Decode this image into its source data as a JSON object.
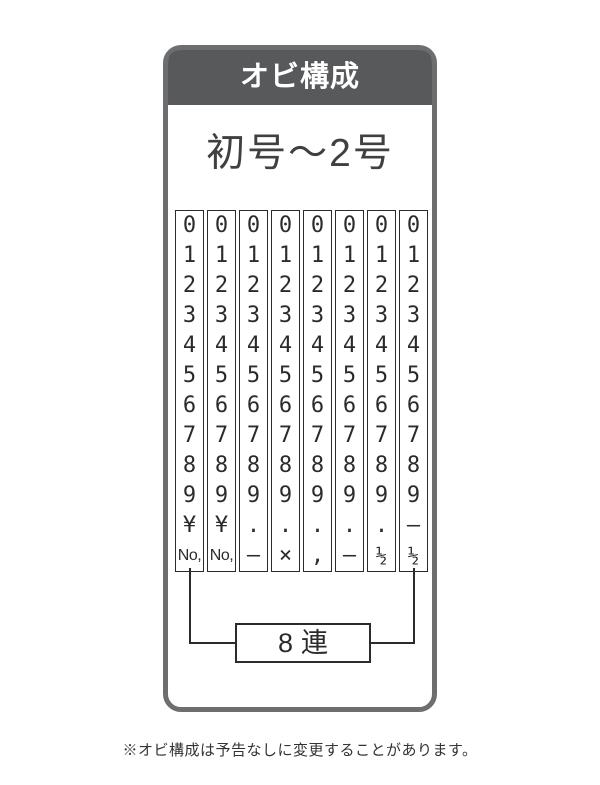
{
  "header": {
    "title": "オビ構成"
  },
  "size_range_label": "初号〜2号",
  "band": {
    "columns": [
      [
        "0",
        "1",
        "2",
        "3",
        "4",
        "5",
        "6",
        "7",
        "8",
        "9",
        "¥",
        "No,"
      ],
      [
        "0",
        "1",
        "2",
        "3",
        "4",
        "5",
        "6",
        "7",
        "8",
        "9",
        "¥",
        "No,"
      ],
      [
        "0",
        "1",
        "2",
        "3",
        "4",
        "5",
        "6",
        "7",
        "8",
        "9",
        ".",
        "–"
      ],
      [
        "0",
        "1",
        "2",
        "3",
        "4",
        "5",
        "6",
        "7",
        "8",
        "9",
        ".",
        "×"
      ],
      [
        "0",
        "1",
        "2",
        "3",
        "4",
        "5",
        "6",
        "7",
        "8",
        "9",
        ".",
        ","
      ],
      [
        "0",
        "1",
        "2",
        "3",
        "4",
        "5",
        "6",
        "7",
        "8",
        "9",
        ".",
        "–"
      ],
      [
        "0",
        "1",
        "2",
        "3",
        "4",
        "5",
        "6",
        "7",
        "8",
        "9",
        ".",
        "½"
      ],
      [
        "0",
        "1",
        "2",
        "3",
        "4",
        "5",
        "6",
        "7",
        "8",
        "9",
        "–",
        "½"
      ]
    ],
    "count_label": "8連"
  },
  "footnote": "※オビ構成は予告なしに変更することがあります。",
  "colors": {
    "header_bg": "#58595b",
    "frame_border": "#6d6e70",
    "ink": "#2b2b2d"
  }
}
